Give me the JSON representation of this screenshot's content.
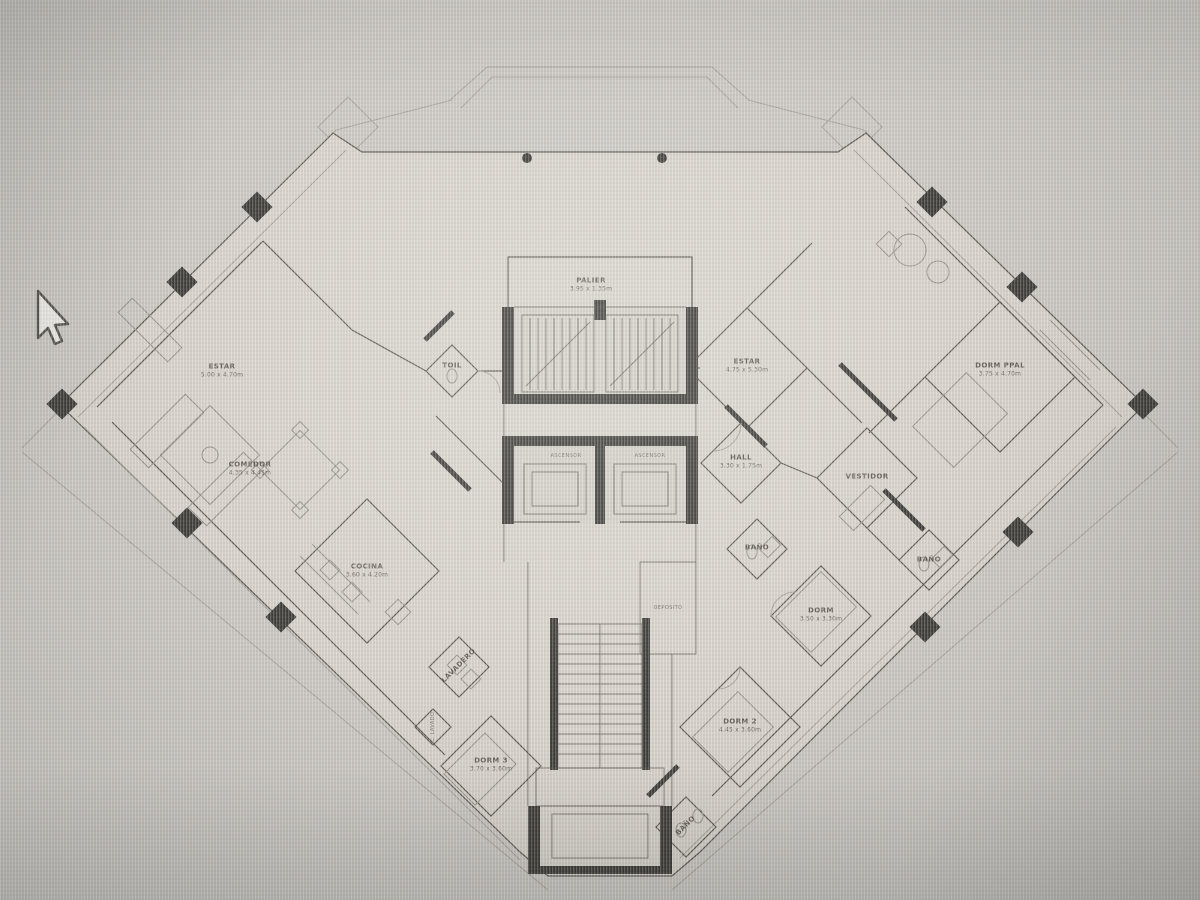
{
  "colors": {
    "bg": "#ccc9c3",
    "paper": "#d8d4cc",
    "paper2": "#d3cfc7",
    "wall": "#5a564f",
    "walldark": "#3c3a36",
    "faint": "#a5a19a",
    "furn": "#93908a",
    "ink": "#4c4840"
  },
  "rooms": [
    {
      "name": "ESTAR",
      "dims": "5.00 x 4.70m"
    },
    {
      "name": "COMEDOR",
      "dims": "4.35 x 4.45m"
    },
    {
      "name": "COCINA",
      "dims": "3.60 x 4.20m"
    },
    {
      "name": "TOIL",
      "dims": ""
    },
    {
      "name": "PALIER",
      "dims": "3.95 x 1.35m"
    },
    {
      "name": "ESTAR",
      "dims": "4.75 x 5.30m"
    },
    {
      "name": "DORM PPAL",
      "dims": "3.75 x 4.70m"
    },
    {
      "name": "HALL",
      "dims": "3.30 x 1.75m"
    },
    {
      "name": "VESTIDOR",
      "dims": ""
    },
    {
      "name": "BAÑO",
      "dims": ""
    },
    {
      "name": "BAÑO",
      "dims": ""
    },
    {
      "name": "DORM",
      "dims": "3.50 x 3.30m"
    },
    {
      "name": "DEPOSITO",
      "dims": ""
    },
    {
      "name": "DORM 2",
      "dims": "4.45 x 3.60m"
    },
    {
      "name": "BAÑO",
      "dims": ""
    },
    {
      "name": "LAVADERO",
      "dims": ""
    },
    {
      "name": "C. LAVADO",
      "dims": ""
    },
    {
      "name": "DORM 3",
      "dims": "3.70 x 3.60m"
    },
    {
      "name": "ASCENSOR",
      "dims": ""
    },
    {
      "name": "ASCENSOR",
      "dims": ""
    }
  ]
}
